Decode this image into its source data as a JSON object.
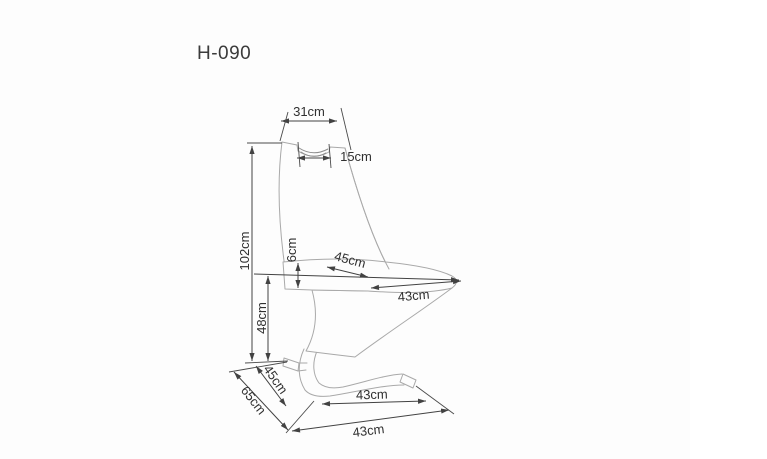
{
  "page": {
    "title": "H-090",
    "background": "#fdfdfd",
    "right_strip_color": "#ffffff"
  },
  "diagram": {
    "type": "furniture-dimension-drawing",
    "subject": "cantilever-z-chair",
    "outline_color": "#a9a9a9",
    "dimension_line_color": "#424242",
    "label_color": "#303030",
    "dimensions": [
      {
        "id": "backrest-top-width",
        "label": "31cm"
      },
      {
        "id": "handle-cutout-width",
        "label": "15cm"
      },
      {
        "id": "total-height",
        "label": "102cm"
      },
      {
        "id": "seat-thickness",
        "label": "6cm"
      },
      {
        "id": "seat-depth",
        "label": "45cm"
      },
      {
        "id": "seat-width",
        "label": "43cm"
      },
      {
        "id": "seat-height",
        "label": "48cm"
      },
      {
        "id": "base-side-depth",
        "label": "45cm"
      },
      {
        "id": "total-depth",
        "label": "65cm"
      },
      {
        "id": "base-runner-length",
        "label": "43cm"
      },
      {
        "id": "base-width",
        "label": "43cm"
      }
    ]
  }
}
